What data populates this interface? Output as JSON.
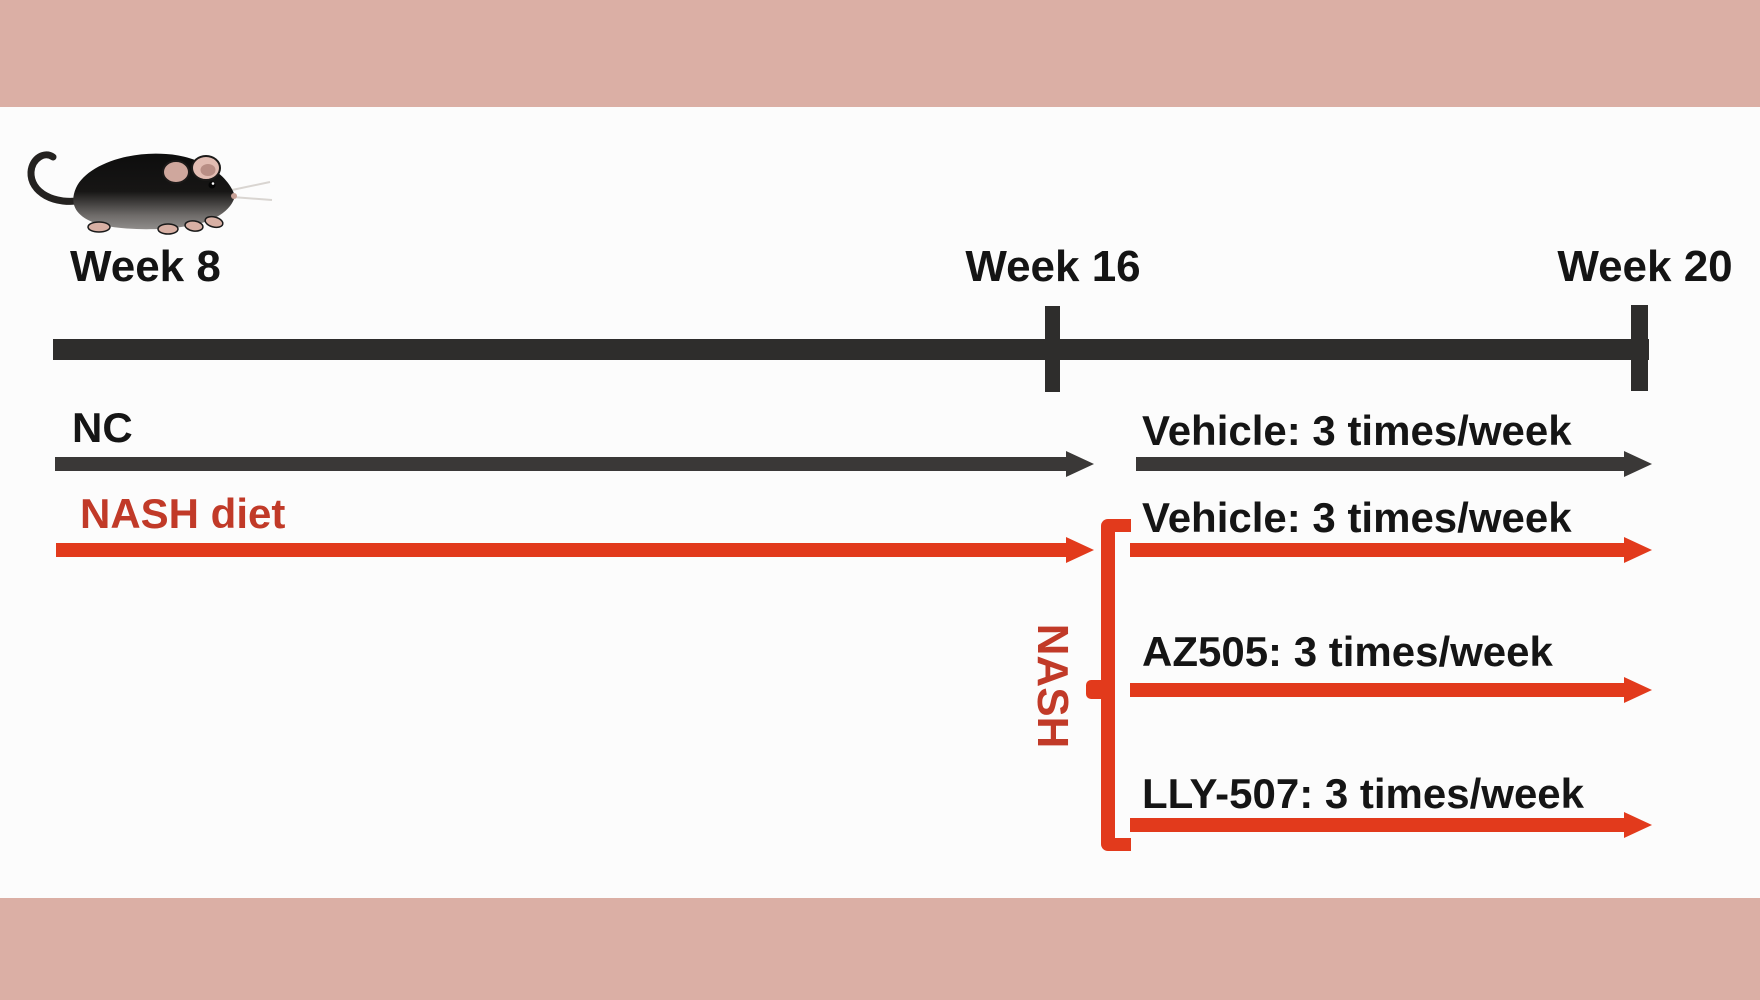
{
  "figure": {
    "type": "experimental-timeline-diagram",
    "weeks": {
      "start": "Week 8",
      "mid": "Week 16",
      "end": "Week 20"
    },
    "nc_group": {
      "diet_label": "NC",
      "treatment": "Vehicle: 3 times/week"
    },
    "nash_group": {
      "diet_label": "NASH diet",
      "bracket_label": "NASH",
      "treatments": [
        "Vehicle: 3 times/week",
        "AZ505: 3 times/week",
        "LLY-507: 3 times/week"
      ],
      "dosing_frequency": "3 times/week"
    },
    "colors": {
      "border_band": "#dbafa5",
      "background": "#fcfcfc",
      "timeline_black": "#2e2d2c",
      "arrow_black": "#3a3837",
      "arrow_red": "#e23a1c",
      "label_dark_red": "#c13a28",
      "text_black": "#151515"
    }
  }
}
